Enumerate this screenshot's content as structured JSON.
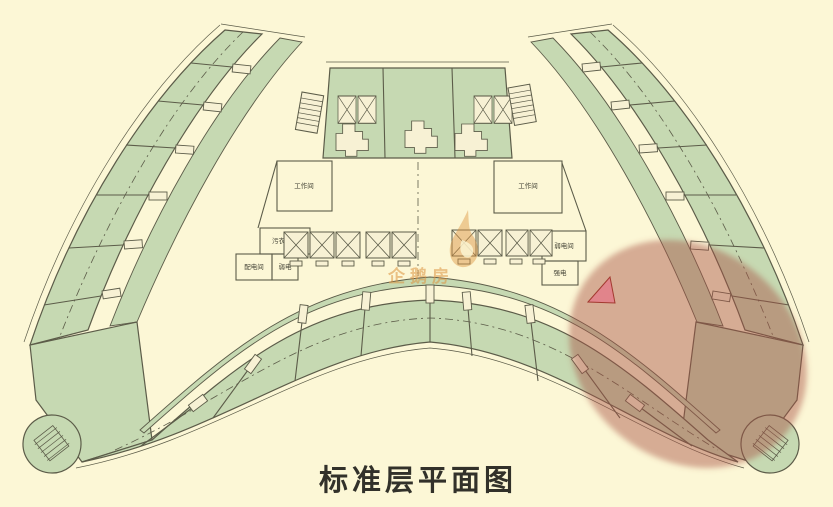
{
  "title": {
    "text": "标准层平面图"
  },
  "watermark": {
    "text": "企鹅房"
  },
  "plan": {
    "rooms": {
      "workroom_left": "工作间",
      "workroom_right": "工作间",
      "linen_storage": "污衣存放",
      "power_distribution": "配电间",
      "weak_current": "弱电",
      "weak_current_room": "弱电间",
      "strong_current": "强电"
    }
  },
  "colors": {
    "background": "#fcf7d6",
    "room_green": "#c6d9b2",
    "corridor": "#f7f1d4",
    "wall": "#5c5c49",
    "highlight_red": "#a85043",
    "highlight_pink": "#e2808a",
    "watermark_orange": "#dd9440",
    "title_color": "#32312a"
  }
}
